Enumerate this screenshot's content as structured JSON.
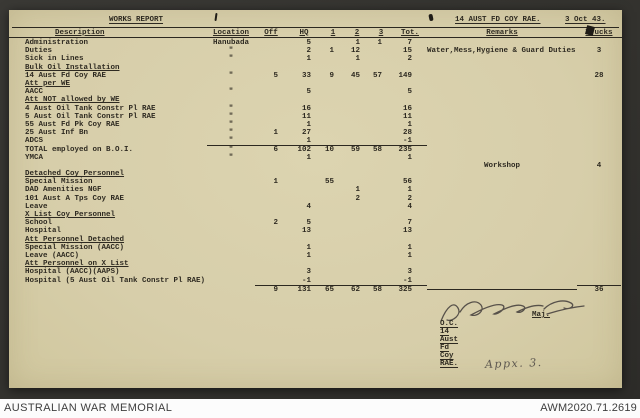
{
  "doc": {
    "title": "WORKS REPORT",
    "unit": "14 AUST FD COY RAE.",
    "date": "3 Oct 43.",
    "columns": [
      "Description",
      "Location",
      "Off",
      "HQ",
      "1",
      "2",
      "3",
      "Tot.",
      "Remarks",
      "Trucks"
    ],
    "rows": [
      {
        "desc": "Administration",
        "loc": "Hanubada",
        "hq": "5",
        "c2": "1",
        "c3": "1",
        "tot": "7"
      },
      {
        "desc": "Duties",
        "loc": "\"",
        "hq": "2",
        "c1": "1",
        "c2": "12",
        "tot": "15",
        "rem": "Water,Mess,Hygiene & Guard Duties",
        "tr": "3"
      },
      {
        "desc": "Sick in Lines",
        "loc": "\"",
        "hq": "1",
        "c2": "1",
        "tot": "2"
      },
      {
        "desc": "Bulk Oil Installation",
        "u": true
      },
      {
        "desc": "14 Aust Fd Coy RAE",
        "loc": "\"",
        "off": "5",
        "hq": "33",
        "c1": "9",
        "c2": "45",
        "c3": "57",
        "tot": "149",
        "tr": "28"
      },
      {
        "desc": "Att per WE",
        "u": true
      },
      {
        "desc": "AACC",
        "loc": "\"",
        "hq": "5",
        "tot": "5"
      },
      {
        "desc": "Att NOT allowed by WE",
        "u": true
      },
      {
        "desc": "4 Aust Oil Tank Constr Pl RAE",
        "loc": "\"",
        "hq": "16",
        "tot": "16"
      },
      {
        "desc": "5 Aust Oil Tank Constr Pl RAE",
        "loc": "\"",
        "hq": "11",
        "tot": "11"
      },
      {
        "desc": "55 Aust Fd Pk Coy RAE",
        "loc": "\"",
        "hq": "1",
        "tot": "1"
      },
      {
        "desc": "25 Aust Inf Bn",
        "loc": "\"",
        "off": "1",
        "hq": "27",
        "tot": "28"
      },
      {
        "desc": "ADCS",
        "loc": "\"",
        "hq": "1",
        "tot": "-1"
      },
      {
        "desc": "TOTAL employed on B.O.I.",
        "loc": "\"",
        "off": "6",
        "hq": "102",
        "c1": "10",
        "c2": "59",
        "c3": "58",
        "tot": "235",
        "variant": "total"
      },
      {
        "desc": "YMCA",
        "loc": "\"",
        "hq": "1",
        "tot": "1"
      },
      {
        "rem": "Workshop",
        "tr": "4",
        "variant": "spacer"
      },
      {
        "desc": "Detached Coy Personnel",
        "u": true
      },
      {
        "desc": "Special Mission",
        "off": "1",
        "c1": "55",
        "tot": "56"
      },
      {
        "desc": "DAD Amenities NGF",
        "c2": "1",
        "tot": "1"
      },
      {
        "desc": "101 Aust A Tps Coy RAE",
        "c2": "2",
        "tot": "2"
      },
      {
        "desc": "Leave",
        "hq": "4",
        "tot": "4"
      },
      {
        "desc": "X List Coy Personnel",
        "u": true
      },
      {
        "desc": "School",
        "off": "2",
        "hq": "5",
        "tot": "7"
      },
      {
        "desc": "Hospital",
        "hq": "13",
        "tot": "13"
      },
      {
        "desc": "Att Personnel Detached",
        "u": true
      },
      {
        "desc": "Special Mission (AACC)",
        "hq": "1",
        "tot": "1"
      },
      {
        "desc": "Leave (AACC)",
        "hq": "1",
        "tot": "1"
      },
      {
        "desc": "Att Personnel on X List",
        "u": true
      },
      {
        "desc": "Hospital (AACC)(AAPS)",
        "hq": "3",
        "tot": "3"
      },
      {
        "desc": "Hospital (5 Aust Oil Tank Constr Pl RAE)",
        "hq": "-1",
        "tot": "-1"
      },
      {
        "off": "9",
        "hq": "131",
        "c1": "65",
        "c2": "62",
        "c3": "58",
        "tot": "325",
        "tr": "36",
        "variant": "grandtotal"
      }
    ],
    "signature": {
      "rank": "Maj.",
      "role": "O.C. 14 Aust Fd Coy RAE.",
      "annotation": "Appx. 3."
    },
    "colors": {
      "paper": "#d8cfaa",
      "ink": "#2e2a21",
      "frame": "#343330"
    }
  },
  "footer": {
    "left": "AUSTRALIAN WAR MEMORIAL",
    "right": "AWM2020.71.2619"
  }
}
